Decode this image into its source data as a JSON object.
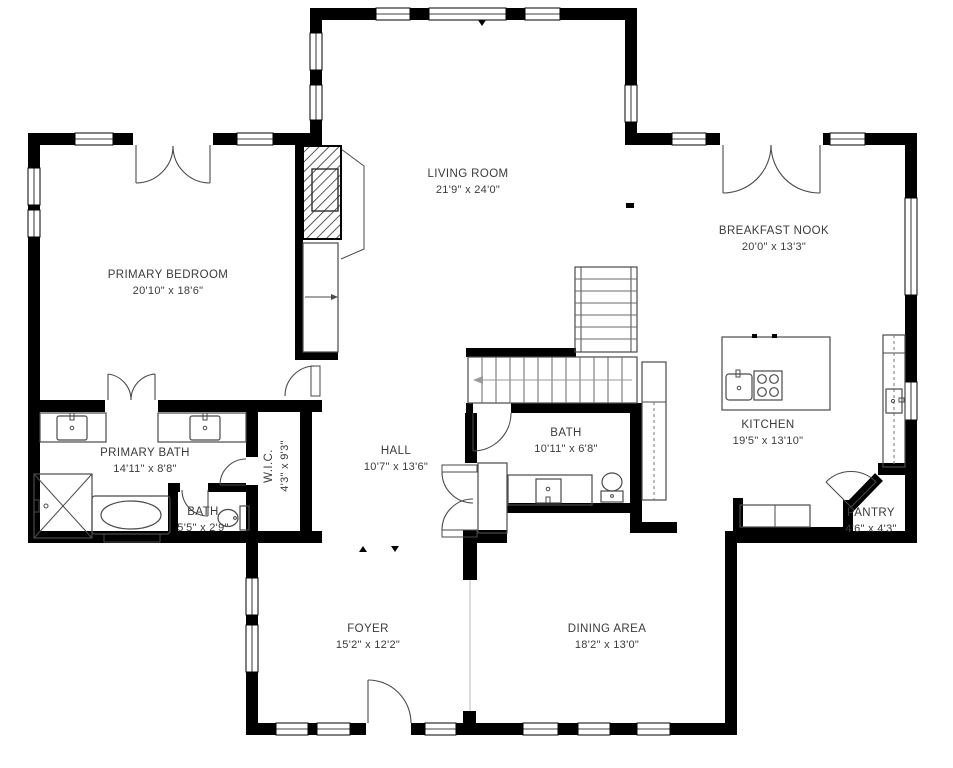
{
  "plan": {
    "type": "residential-floor-plan",
    "wall_color": "#000000",
    "background": "#ffffff",
    "fixture_line_color": "#4a4a4a"
  },
  "rooms": [
    {
      "name": "LIVING ROOM",
      "dims": "21'9\" x 24'0\""
    },
    {
      "name": "BREAKFAST NOOK",
      "dims": "20'0\" x 13'3\""
    },
    {
      "name": "PRIMARY BEDROOM",
      "dims": "20'10\" x 18'6\""
    },
    {
      "name": "PRIMARY BATH",
      "dims": "14'11\" x 8'8\""
    },
    {
      "name": "BATH",
      "dims": "5'5\" x 2'9\""
    },
    {
      "name": "W.I.C.",
      "dims": "4'3\" x 9'3\""
    },
    {
      "name": "HALL",
      "dims": "10'7\" x 13'6\""
    },
    {
      "name": "BATH",
      "dims": "10'11\" x 6'8\""
    },
    {
      "name": "KITCHEN",
      "dims": "19'5\" x 13'10\""
    },
    {
      "name": "PANTRY",
      "dims": "4'6\" x 4'3\""
    },
    {
      "name": "FOYER",
      "dims": "15'2\" x 12'2\""
    },
    {
      "name": "DINING AREA",
      "dims": "18'2\" x 13'0\""
    }
  ]
}
